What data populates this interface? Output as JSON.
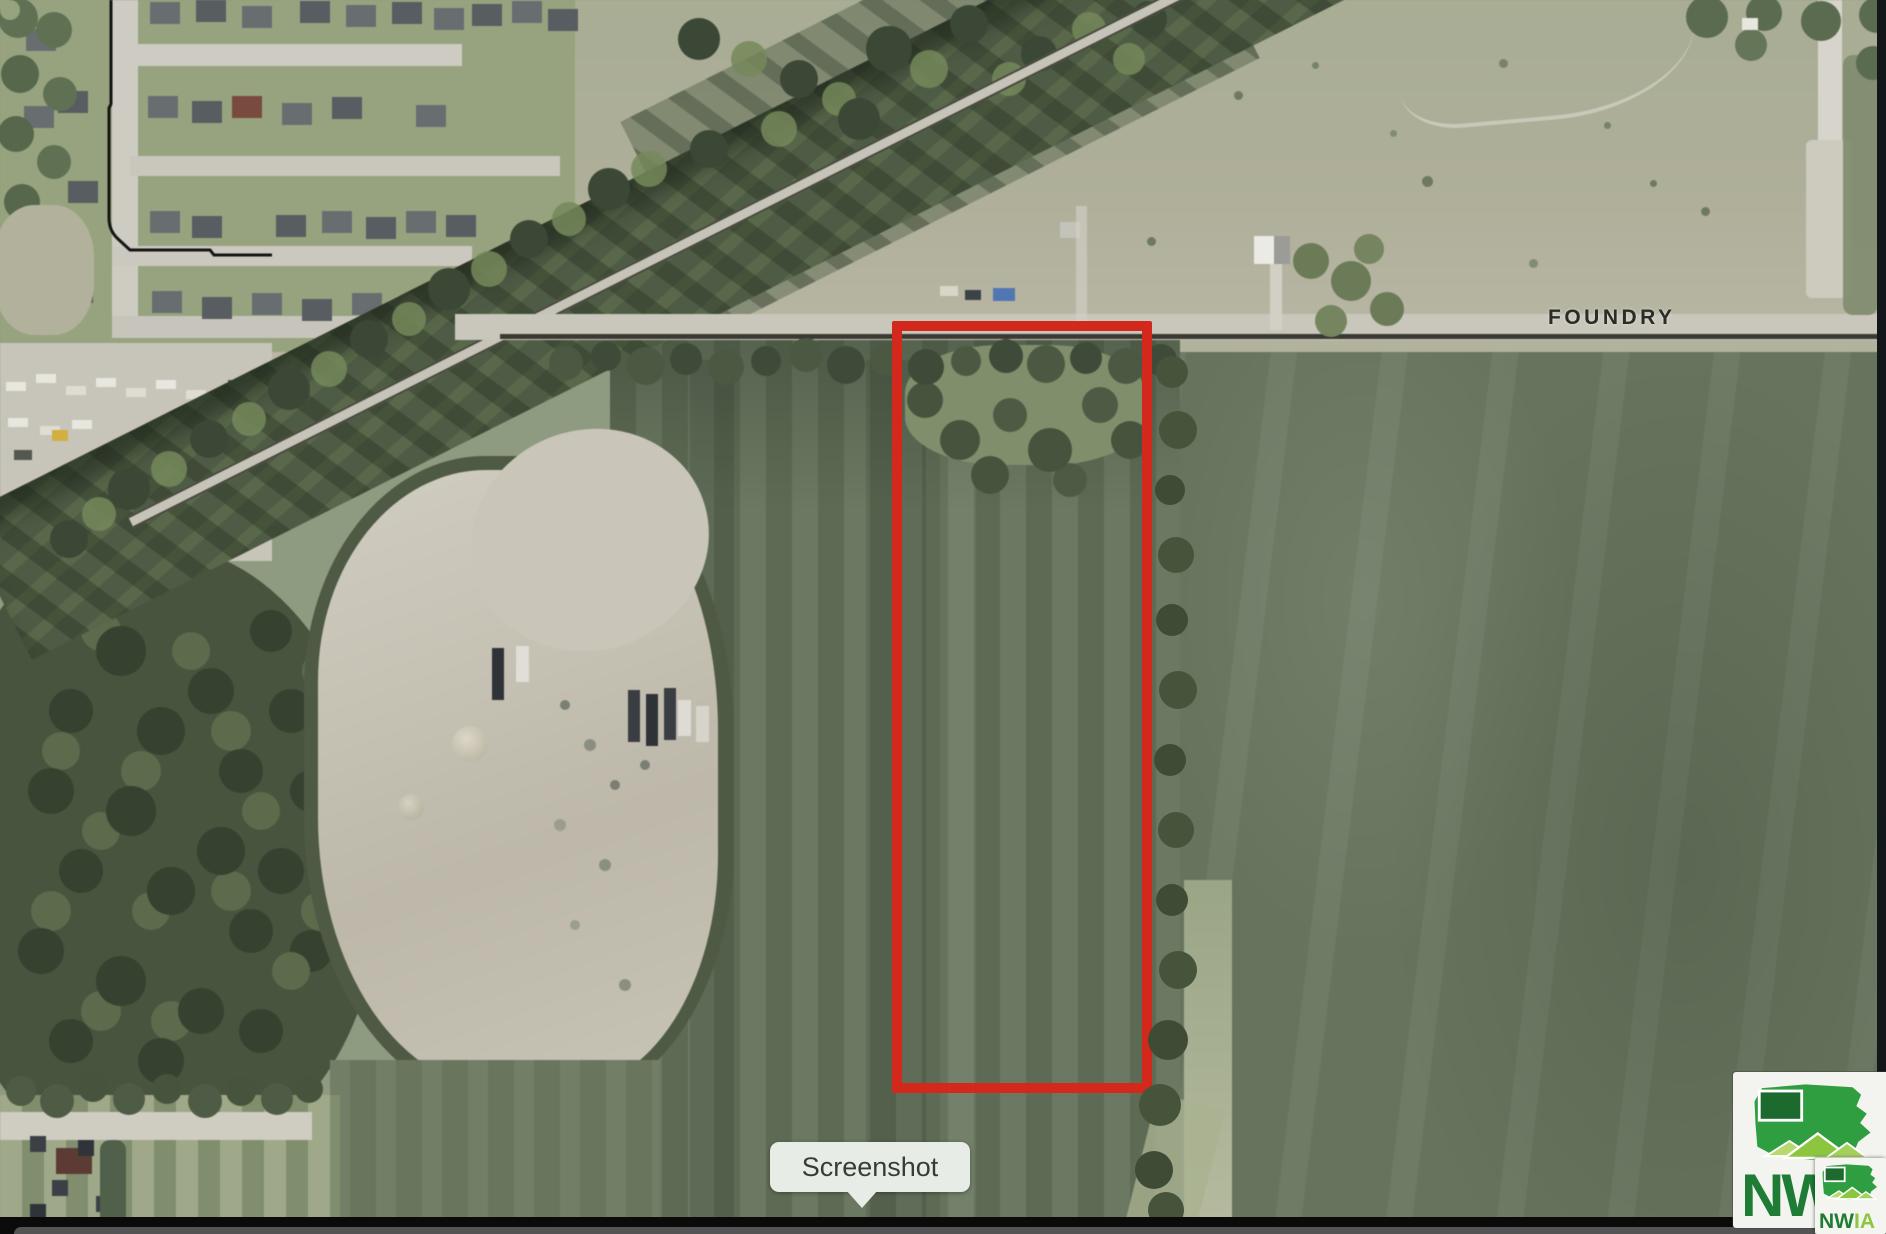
{
  "road": {
    "label": "FOUNDRY"
  },
  "tooltip": {
    "label": "Screenshot"
  },
  "parcel": {
    "outline_color": "#d2291c"
  },
  "watermark": {
    "large_text": "NW",
    "small_nw": "NW",
    "small_ia": "IA",
    "brand_green": "#2f9e41",
    "brand_green_dark": "#1c6a2e",
    "brand_green_light": "#8cc63f"
  }
}
